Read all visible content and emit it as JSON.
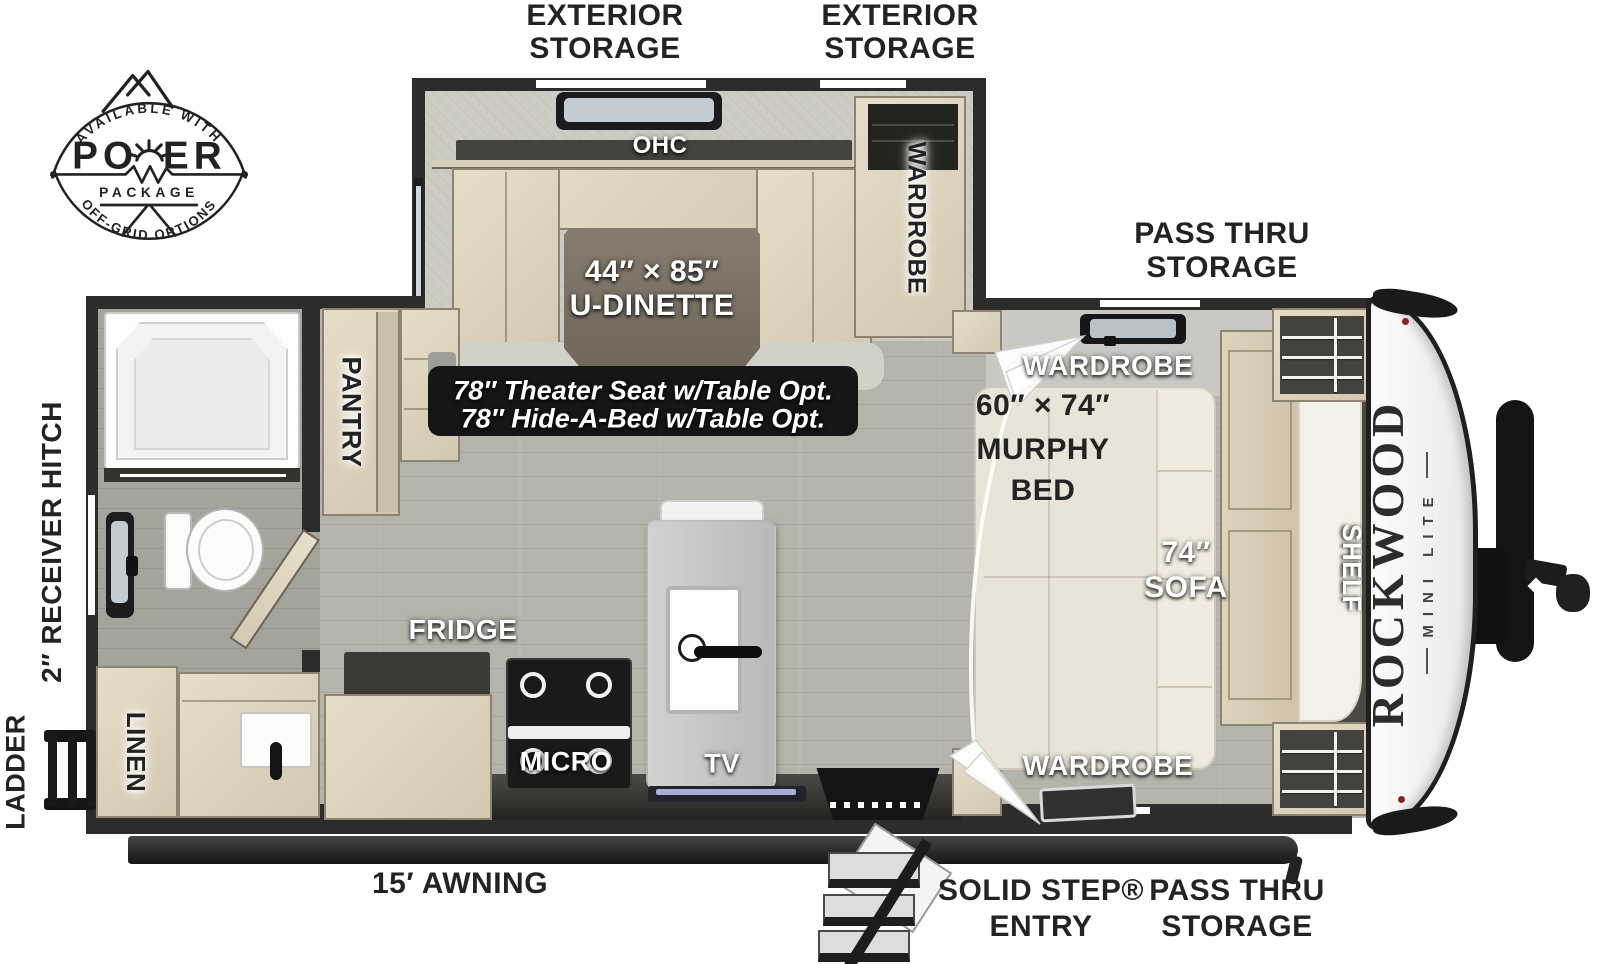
{
  "badge": {
    "arc_top": "AVAILABLE WITH",
    "arc_bottom": "OFF-GRID OPTIONS",
    "word_left": "PO",
    "word_right": "ER",
    "word_sub": "PACKAGE"
  },
  "brand": {
    "name": "ROCKWOOD",
    "sub": "MINI LITE"
  },
  "labels": {
    "exterior_storage_l1": "EXTERIOR",
    "exterior_storage_l2": "STORAGE",
    "pass_thru_l1": "PASS THRU",
    "pass_thru_l2": "STORAGE",
    "ohc": "OHC",
    "wardrobe": "WARDROBE",
    "dinette_l1": "44″ × 85″",
    "dinette_l2": "U-DINETTE",
    "note_l1": "78″ Theater Seat w/Table Opt.",
    "note_l2": "78″ Hide-A-Bed w/Table Opt.",
    "murphy_l1": "60″ × 74″",
    "murphy_l2": "MURPHY",
    "murphy_l3": "BED",
    "sofa_l1": "74″",
    "sofa_l2": "SOFA",
    "shelf": "SHELF",
    "pantry": "PANTRY",
    "fridge": "FRIDGE",
    "micro": "MICRO",
    "tv": "TV",
    "linen": "LINEN",
    "ladder": "LADDER",
    "receiver_hitch": "2″ RECEIVER HITCH",
    "awning": "15′ AWNING",
    "solid_step_l1": "SOLID STEP®",
    "solid_step_l2": "ENTRY"
  },
  "colors": {
    "wall": "#2c2c2a",
    "cabinet": "#d9cfba",
    "table": "#7b7164",
    "floor": "#b4b3ac",
    "note_bg": "#161616",
    "bed": "#e9e4d8",
    "tv_screen": "#a9aed6"
  }
}
